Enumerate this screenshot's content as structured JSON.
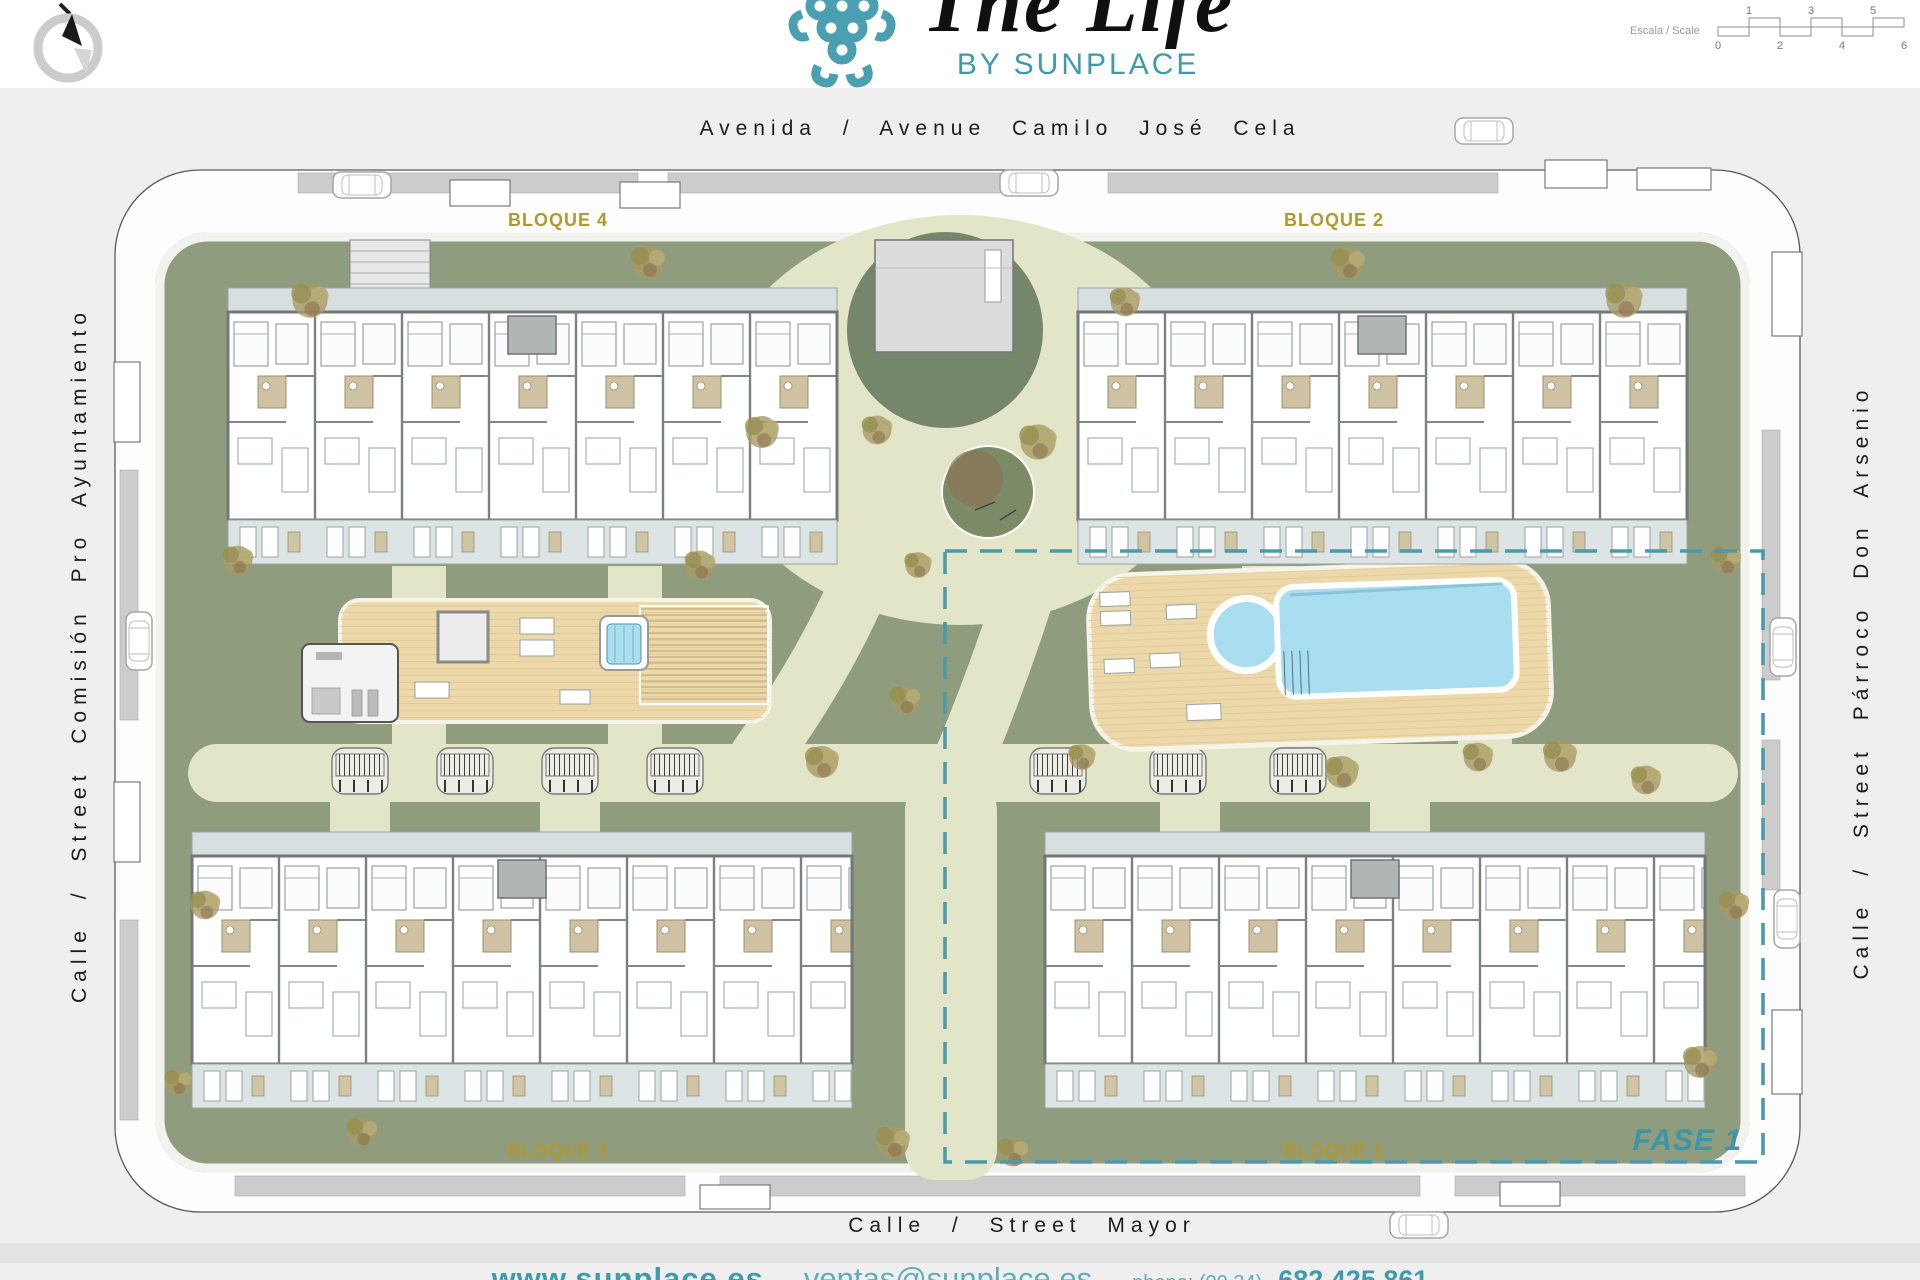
{
  "header": {
    "title": "The Life",
    "subtitle": "BY SUNPLACE",
    "scale": {
      "label": "Escala / Scale",
      "ticks_top": [
        "1",
        "3",
        "5"
      ],
      "ticks_bottom": [
        "0",
        "2",
        "4",
        "6"
      ]
    }
  },
  "streets": {
    "top": "Avenida / Avenue Camilo José Cela",
    "left": "Calle / Street Comisión Pro Ayuntamiento",
    "right": "Calle / Street Párroco Don Arsenio",
    "bottom": "Calle / Street Mayor"
  },
  "blocks": {
    "bloque1": "BLOQUE 1",
    "bloque2": "BLOQUE 2",
    "bloque3": "BLOQUE 3",
    "bloque4": "BLOQUE 4"
  },
  "phase": {
    "label": "FASE 1"
  },
  "footer": {
    "website": "www.sunplace.es",
    "separator": "-",
    "email": "ventas@sunplace.es",
    "phone_label": "phone: (00 34)",
    "phone_number": "682 425 861"
  },
  "colors": {
    "brand_teal": "#3f9aab",
    "bloque_gold": "#b1982f",
    "pool_blue": "#a9def1",
    "deck_tan": "#ecd8a8",
    "grass_green": "#8f9c7e",
    "path_cream": "#e2e5c7",
    "phase_dash": "#4b9aab"
  }
}
